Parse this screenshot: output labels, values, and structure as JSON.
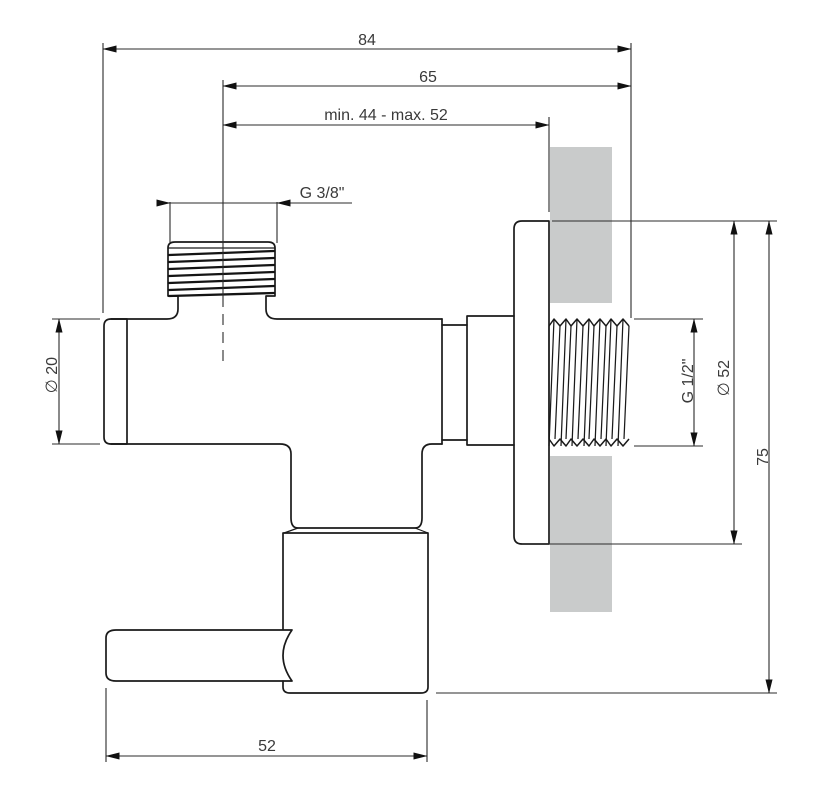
{
  "drawing": {
    "dim_overall_width": "84",
    "dim_body_to_axis": "65",
    "dim_wall_range": "min. 44 - max. 52",
    "label_top_thread": "G 3/8\"",
    "label_body_diameter": "∅ 20",
    "label_outlet_thread": "G 1/2\"",
    "label_flange_diameter": "∅ 52",
    "dim_height": "75",
    "dim_handle_length": "52",
    "colors": {
      "outline": "#1a1a1a",
      "dimension_line": "#2b2b2b",
      "wall": "#c9cbcb",
      "text": "#3a3a3a",
      "background": "#ffffff"
    }
  }
}
